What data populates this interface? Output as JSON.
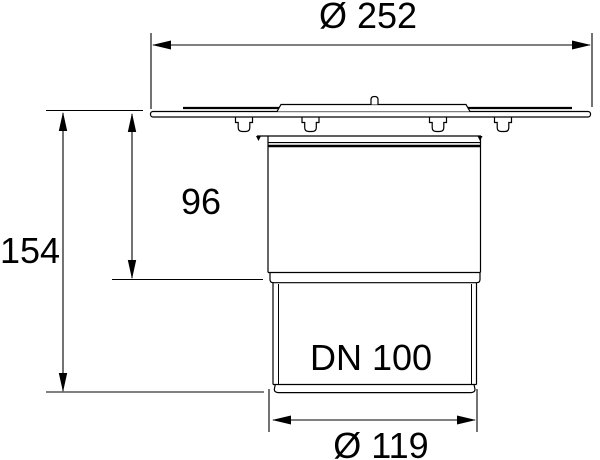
{
  "diagram": {
    "type": "technical-dimension-drawing",
    "subject": "floor-drain-body-side-view",
    "colors": {
      "line": "#000000",
      "background": "#ffffff"
    },
    "dimensions": [
      {
        "name": "flange-diameter",
        "label": "Ø 252",
        "value": 252,
        "orientation": "horizontal",
        "position": "top"
      },
      {
        "name": "upper-body-height",
        "label": "96",
        "value": 96,
        "orientation": "vertical",
        "position": "left-inner"
      },
      {
        "name": "total-height",
        "label": "154",
        "value": 154,
        "orientation": "vertical",
        "position": "left-outer"
      },
      {
        "name": "outlet-size",
        "label": "DN 100",
        "orientation": "none",
        "position": "on-outlet-pipe"
      },
      {
        "name": "outlet-diameter",
        "label": "Ø 119",
        "value": 119,
        "orientation": "horizontal",
        "position": "bottom"
      }
    ]
  }
}
